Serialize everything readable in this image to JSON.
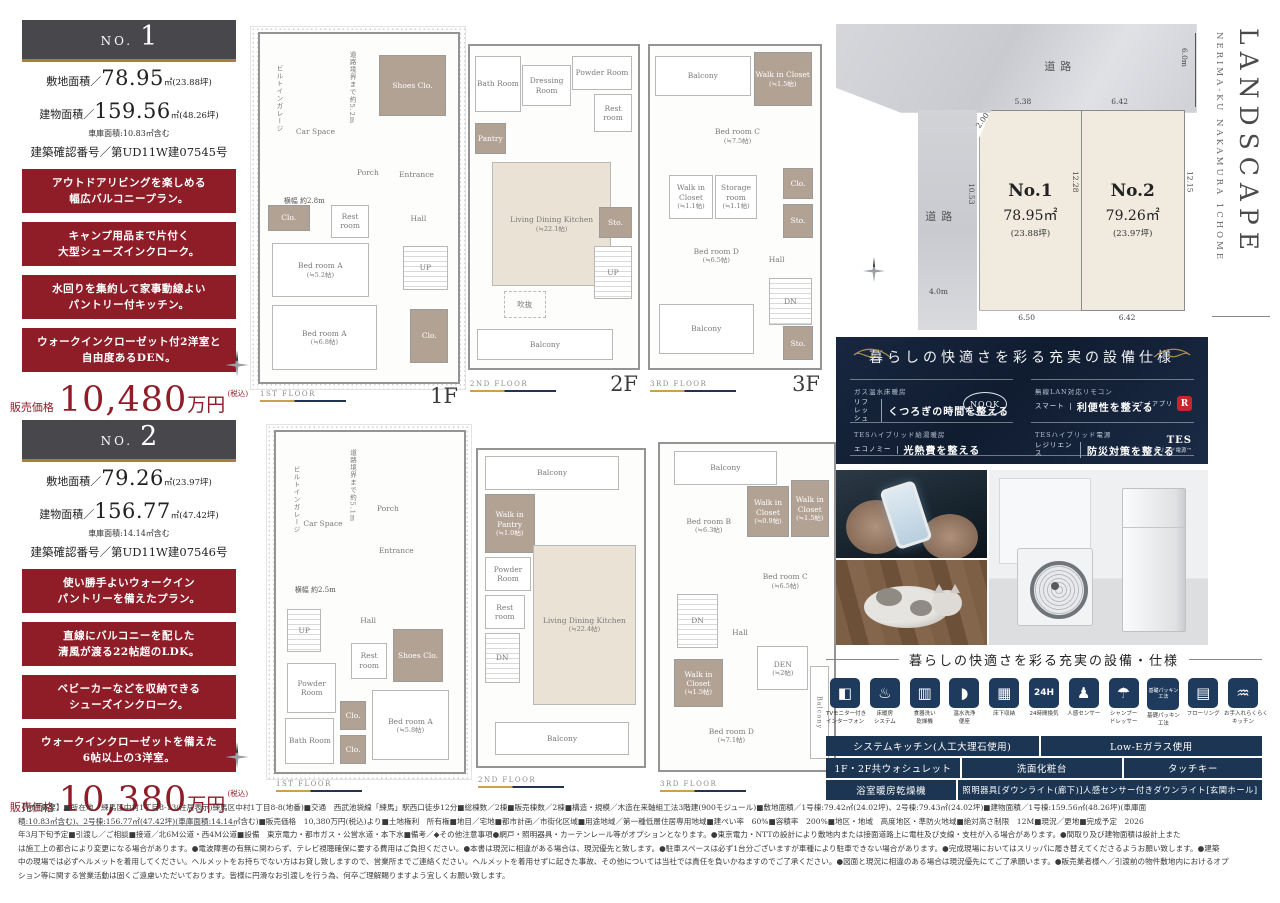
{
  "colors": {
    "accent_red": "#8e1d28",
    "navy_panel": "#16243c",
    "table_navy": "#1c3552",
    "gold": "#a8803a"
  },
  "no1": {
    "no_label": "NO.",
    "no_num": "1",
    "land_label": "敷地面積／",
    "land_num": "78.95",
    "land_tail": "㎡(23.88坪)",
    "bldg_label": "建物面積／",
    "bldg_num": "159.56",
    "bldg_tail": "㎡(48.26坪)",
    "garage_note": "車庫面積:10.83㎡含む",
    "confirm": "建築確認番号／第UD11W建07545号",
    "features": [
      {
        "l1": "アウトドアリビングを楽しめる",
        "l2": "幅広バルコニープラン。"
      },
      {
        "l1": "キャンプ用品まで片付く",
        "l2": "大型シューズインクローク。"
      },
      {
        "l1": "水回りを集約して家事動線よい",
        "l2": "パントリー付キッチン。"
      },
      {
        "l1": "ウォークインクローゼット付2洋室と",
        "l2": "自由度あるDEN。"
      }
    ],
    "price_label": "販売価格",
    "price_num": "10,480",
    "price_unit": "万円",
    "price_tax": "(税込)"
  },
  "no2": {
    "no_label": "NO.",
    "no_num": "2",
    "land_label": "敷地面積／",
    "land_num": "79.26",
    "land_tail": "㎡(23.97坪)",
    "bldg_label": "建物面積／",
    "bldg_num": "156.77",
    "bldg_tail": "㎡(47.42坪)",
    "garage_note": "車庫面積:14.14㎡含む",
    "confirm": "建築確認番号／第UD11W建07546号",
    "features": [
      {
        "l1": "使い勝手よいウォークイン",
        "l2": "パントリーを備えたプラン。"
      },
      {
        "l1": "直線にバルコニーを配した",
        "l2": "清風が渡る22帖超のLDK。"
      },
      {
        "l1": "ベビーカーなどを収納できる",
        "l2": "シューズインクローク。"
      },
      {
        "l1": "ウォークインクローゼットを備えた",
        "l2": "6帖以上の3洋室。"
      }
    ],
    "price_label": "販売価格",
    "price_num": "10,380",
    "price_unit": "万円",
    "price_tax": "(税込)"
  },
  "plans": {
    "n1f1": {
      "bar": "1ST FLOOR",
      "big": "1F",
      "car": "Car Space",
      "garage": "ビルトインガレージ",
      "depth": "道路境界まで約5.2m",
      "width": "横幅 約2.8m",
      "shoes": "Shoes Clo.",
      "porch": "Porch",
      "entrance": "Entrance",
      "rest": "Rest room",
      "clo1": "Clo.",
      "hall": "Hall",
      "up": "UP",
      "bedA1": "Bed room A",
      "bedA1s": "(≒5.2帖)",
      "bedA2": "Bed room A",
      "bedA2s": "(≒6.8帖)",
      "clo2": "Clo."
    },
    "n1f2": {
      "bar": "2ND FLOOR",
      "big": "2F",
      "bath": "Bath Room",
      "dress": "Dressing Room",
      "powder": "Powder Room",
      "rest": "Rest room",
      "pantry": "Pantry",
      "ldk": "Living Dining Kitchen",
      "ldks": "(≒22.1帖)",
      "void": "吹抜",
      "sto": "Sto.",
      "up": "UP",
      "balcony": "Balcony"
    },
    "n1f3": {
      "bar": "3RD FLOOR",
      "big": "3F",
      "balcony_t": "Balcony",
      "wic1": "Walk in Closet",
      "wic1s": "(≒1.5帖)",
      "bedC": "Bed room C",
      "bedCs": "(≒7.5帖)",
      "wic2": "Walk in Closet",
      "wic2s": "(≒1.1帖)",
      "stor": "Storage room",
      "stors": "(≒1.1帖)",
      "clo": "Clo.",
      "sto1": "Sto.",
      "bedD": "Bed room D",
      "bedDs": "(≒6.5帖)",
      "hall": "Hall",
      "dn": "DN",
      "balcony_b": "Balcony",
      "sto2": "Sto."
    },
    "n2f1": {
      "bar": "1ST FLOOR",
      "car": "Car Space",
      "garage": "ビルトインガレージ",
      "depth": "道路境界まで約5.1m",
      "width": "横幅 約2.5m",
      "porch": "Porch",
      "entrance": "Entrance",
      "up": "UP",
      "hall": "Hall",
      "rest": "Rest room",
      "shoes": "Shoes Clo.",
      "powder": "Powder Room",
      "bath": "Bath Room",
      "clo1": "Clo.",
      "clo2": "Clo.",
      "bedA": "Bed room A",
      "bedAs": "(≒5.8帖)"
    },
    "n2f2": {
      "bar": "2ND FLOOR",
      "balcony_t": "Balcony",
      "wip": "Walk in Pantry",
      "wips": "(≒1.0帖)",
      "powder": "Powder Room",
      "rest": "Rest room",
      "dn": "DN",
      "ldk": "Living Dining Kitchen",
      "ldks": "(≒22.4帖)",
      "balcony_b": "Balcony"
    },
    "n2f3": {
      "bar": "3RD FLOOR",
      "balcony_t": "Balcony",
      "wic1": "Walk in Closet",
      "wic1s": "(≒0.9帖)",
      "wic2": "Walk in Closet",
      "wic2s": "(≒1.5帖)",
      "bedB": "Bed room B",
      "bedBs": "(≒6.3帖)",
      "bedC": "Bed room C",
      "bedCs": "(≒6.5帖)",
      "dn": "DN",
      "hall": "Hall",
      "wic3": "Walk in Closet",
      "wic3s": "(≒1.5帖)",
      "den": "DEN",
      "dens": "(≒2帖)",
      "bedD": "Bed room D",
      "bedDs": "(≒7.1帖)",
      "balcony_r": "Balcony"
    }
  },
  "site": {
    "road_top": "道路",
    "road_left": "道路",
    "en_location": "NERIMA-KU NAKAMURA 1CHOME",
    "en_title": "LANDSCAPE",
    "lot1_name": "No.1",
    "lot1_area": "78.95㎡",
    "lot1_tsubo": "(23.88坪)",
    "lot2_name": "No.2",
    "lot2_area": "79.26㎡",
    "lot2_tsubo": "(23.97坪)",
    "dim_6m": "6.0m",
    "dim_538": "5.38",
    "dim_642t": "6.42",
    "dim_200": "2.00",
    "dim_1053": "10.53",
    "dim_1228": "12.28",
    "dim_1215": "12.15",
    "dim_4m": "4.0m",
    "dim_650": "6.50",
    "dim_642b": "6.42"
  },
  "spec_panel": {
    "title": "暮らしの快適さを彩る充実の設備仕様",
    "items": [
      {
        "cat": "ガス温水床暖房",
        "tag": "リフレッシュ",
        "desc": "くつろぎの時間を整える",
        "badge": "NOOK"
      },
      {
        "cat": "無線LAN対応リモコン",
        "tag": "スマート",
        "desc": "利便性を整える",
        "badge": "リンナイアプリ",
        "logo": "R"
      },
      {
        "cat": "TESハイブリッド給湯暖房",
        "tag": "エコノミー",
        "desc": "光熱費を整える"
      },
      {
        "cat": "TESハイブリッド電源",
        "tag": "レジリエンス",
        "desc": "防災対策を整える",
        "badge": "TES",
        "badge2": "ハイブリッド電源™"
      }
    ]
  },
  "equipment": {
    "title": "暮らしの快適さを彩る充実の設備・仕様",
    "icons": [
      {
        "glyph": "◧",
        "l1": "TVモニター付き",
        "l2": "インターフォン"
      },
      {
        "glyph": "♨",
        "l1": "床暖房",
        "l2": "システム"
      },
      {
        "glyph": "▥",
        "l1": "食器洗い",
        "l2": "乾燥機"
      },
      {
        "glyph": "◗",
        "l1": "温水洗浄",
        "l2": "便座"
      },
      {
        "glyph": "▦",
        "l1": "床下収納",
        "l2": ""
      },
      {
        "glyph": "24H",
        "l1": "24時間換気",
        "l2": ""
      },
      {
        "glyph": "♟",
        "l1": "人感センサー",
        "l2": ""
      },
      {
        "glyph": "☂",
        "l1": "シャンプー",
        "l2": "ドレッサー"
      },
      {
        "glyph": "基礎パッキン工法",
        "l1": "基礎パッキン",
        "l2": "工法"
      },
      {
        "glyph": "▤",
        "l1": "フローリング",
        "l2": ""
      },
      {
        "glyph": "♒",
        "l1": "お手入れらくらく",
        "l2": "キッチン"
      }
    ],
    "rows": [
      [
        "システムキッチン(人工大理石使用)",
        "Low-Eガラス使用"
      ],
      [
        "1F・2F共ウォシュレット",
        "洗面化粧台",
        "タッチキー"
      ],
      [
        "浴室暖房乾燥機",
        "照明器具[ダウンライト(廊下)]人感センサー付きダウンライト[玄関ホール]"
      ]
    ]
  },
  "legal": {
    "lines": [
      "【物件概要】■所在地／練馬区中村1丁目8-13(住居表示)練馬区中村1丁目8-8(地番)■交通　西武池袋線「練馬」駅西口徒歩12分■総棟数／2棟■販売棟数／2棟■構造・規模／木造在来軸組工法3階建(900モジュール)■敷地面積／1号棟:79.42㎡(24.02坪)、2号棟:79.43㎡(24.02坪)■建物面積／1号棟:159.56㎡(48.26坪)(車庫面",
      "積:10.83㎡含む)、2号棟:156.77㎡(47.42坪)(車庫面積:14.14㎡含む)■販売価格　10,380万円(税込)より■土地権利　所有権■地目／宅地■都市計画／市街化区域■用途地域／第一種低層住居専用地域■建ぺい率　60%■容積率　200%■地区・地域　高度地区・準防火地域■絶対高さ制限　12M■現況／更地■完成予定　2026",
      "年3月下旬予定■引渡し／ご相談■接道／北6M公道・西4M公道■設備　東京電力・都市ガス・公営水道・本下水■備考／◆その他注意事項●網戸・照明器具・カーテンレール等がオプションとなります。●東京電力・NTTの設計により敷地内または接面道路上に電柱及び支線・支柱が入る場合があります。●間取り及び建物面積は設計上また",
      "は施工上の都合により変更になる場合があります。●電波障害の有無に関わらず、テレビ視聴確保に要する費用はご負担ください。●本書は現況に相違がある場合は、現況優先と致します。●駐車スペースは必ず1台分ございますが車種により駐車できない場合があります。●完成現場においてはスリッパに履き替えてくださるようお願い致します。●建築",
      "中の現場では必ずヘルメットを着用してください。ヘルメットをお持ちでない方はお貸し致しますので、営業所までご連絡ください。ヘルメットを着用せずに起きた事故、その他については当社では責任を負いかねますのでご了承ください。●図面と現況に相違のある場合は現況優先にてご了承願います。●販売業者様へ／引渡前の物件敷地内におけるオプ",
      "ション等に関する営業活動は固くご遠慮いただいております。皆様に円滑なお引渡しを行う為、何卒ご理解賜りますよう宜しくお願い致します。"
    ]
  }
}
